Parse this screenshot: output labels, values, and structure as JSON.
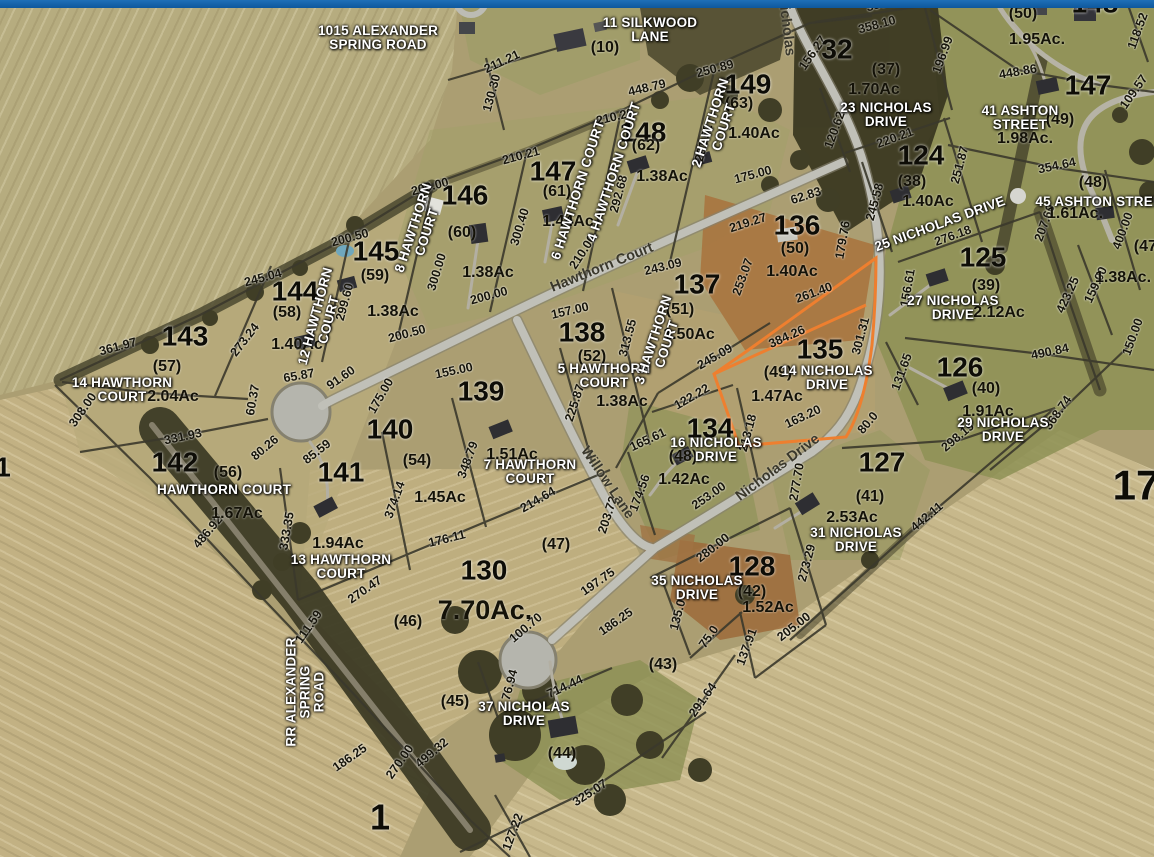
{
  "app": {
    "top_bar_color": "#1266ad",
    "highlight_color": "#ee7f2f"
  },
  "map": {
    "streets": [
      {
        "t": "Hawthorn Court",
        "x": 602,
        "y": 268,
        "r": -22
      },
      {
        "t": "Willow Lane",
        "x": 607,
        "y": 483,
        "r": 56
      },
      {
        "t": "Nicholas Drive",
        "x": 778,
        "y": 468,
        "r": -37
      },
      {
        "t": "Nicholas",
        "x": 786,
        "y": 26,
        "r": 83
      }
    ],
    "addresses": [
      {
        "lines": [
          "1015 ALEXANDER",
          "SPRING ROAD"
        ],
        "x": 378,
        "y": 38
      },
      {
        "lines": [
          "11 SILKWOOD",
          "LANE"
        ],
        "x": 650,
        "y": 30
      },
      {
        "lines": [
          "23 NICHOLAS",
          "DRIVE"
        ],
        "x": 886,
        "y": 115
      },
      {
        "lines": [
          "41 ASHTON",
          "STREET"
        ],
        "x": 1020,
        "y": 118
      },
      {
        "lines": [
          "45 ASHTON STREET"
        ],
        "x": 1103,
        "y": 202
      },
      {
        "lines": [
          "25 NICHOLAS DRIVE"
        ],
        "x": 940,
        "y": 224,
        "r": -20
      },
      {
        "lines": [
          "27 NICHOLAS",
          "DRIVE"
        ],
        "x": 953,
        "y": 308
      },
      {
        "lines": [
          "29 NICHOLAS",
          "DRIVE"
        ],
        "x": 1003,
        "y": 430
      },
      {
        "lines": [
          "31 NICHOLAS",
          "DRIVE"
        ],
        "x": 856,
        "y": 540
      },
      {
        "lines": [
          "14 NICHOLAS",
          "DRIVE"
        ],
        "x": 827,
        "y": 378
      },
      {
        "lines": [
          "16 NICHOLAS",
          "DRIVE"
        ],
        "x": 716,
        "y": 450
      },
      {
        "lines": [
          "35 NICHOLAS",
          "DRIVE"
        ],
        "x": 697,
        "y": 588
      },
      {
        "lines": [
          "37 NICHOLAS",
          "DRIVE"
        ],
        "x": 524,
        "y": 714
      },
      {
        "lines": [
          "14 HAWTHORN",
          "COURT"
        ],
        "x": 122,
        "y": 390
      },
      {
        "lines": [
          "HAWTHORN COURT"
        ],
        "x": 224,
        "y": 490
      },
      {
        "lines": [
          "5 HAWTHORN",
          "COURT"
        ],
        "x": 604,
        "y": 376
      },
      {
        "lines": [
          "7 HAWTHORN",
          "COURT"
        ],
        "x": 530,
        "y": 472
      },
      {
        "lines": [
          "13 HAWTHORN",
          "COURT"
        ],
        "x": 341,
        "y": 567
      },
      {
        "lines": [
          "3 HAWTHORN",
          "COURT"
        ],
        "x": 660,
        "y": 342,
        "r": -72
      },
      {
        "lines": [
          "2 HAWTHORN",
          "COURT"
        ],
        "x": 717,
        "y": 125,
        "r": -72
      },
      {
        "lines": [
          "4 HAWTHORN COURT"
        ],
        "x": 614,
        "y": 172,
        "r": -72
      },
      {
        "lines": [
          "6 HAWTHORN COURT"
        ],
        "x": 578,
        "y": 190,
        "r": -72
      },
      {
        "lines": [
          "8 HAWTHORN",
          "COURT"
        ],
        "x": 420,
        "y": 230,
        "r": -72
      },
      {
        "lines": [
          "12 HAWTHORN",
          "COURT"
        ],
        "x": 322,
        "y": 318,
        "r": -75
      },
      {
        "lines": [
          "RR ALEXANDER",
          "SPRING",
          "ROAD"
        ],
        "x": 305,
        "y": 692,
        "r": -90
      }
    ],
    "parcel_numbers": [
      {
        "n": "143",
        "x": 185,
        "y": 337
      },
      {
        "n": "144",
        "x": 295,
        "y": 292
      },
      {
        "n": "145",
        "x": 376,
        "y": 252
      },
      {
        "n": "146",
        "x": 465,
        "y": 196
      },
      {
        "n": "147",
        "x": 553,
        "y": 172
      },
      {
        "n": "148",
        "x": 643,
        "y": 133
      },
      {
        "n": "149",
        "x": 748,
        "y": 85
      },
      {
        "n": "137",
        "x": 697,
        "y": 285
      },
      {
        "n": "138",
        "x": 582,
        "y": 333
      },
      {
        "n": "139",
        "x": 481,
        "y": 392
      },
      {
        "n": "140",
        "x": 390,
        "y": 430
      },
      {
        "n": "141",
        "x": 341,
        "y": 473
      },
      {
        "n": "142",
        "x": 175,
        "y": 463
      },
      {
        "n": "130",
        "x": 484,
        "y": 571
      },
      {
        "n": "134",
        "x": 710,
        "y": 429
      },
      {
        "n": "135",
        "x": 820,
        "y": 350
      },
      {
        "n": "136",
        "x": 797,
        "y": 226
      },
      {
        "n": "124",
        "x": 921,
        "y": 156
      },
      {
        "n": "125",
        "x": 983,
        "y": 258
      },
      {
        "n": "126",
        "x": 960,
        "y": 368
      },
      {
        "n": "127",
        "x": 882,
        "y": 463
      },
      {
        "n": "128",
        "x": 752,
        "y": 567
      },
      {
        "n": "32",
        "x": 837,
        "y": 50
      },
      {
        "n": "17",
        "x": 1136,
        "y": 486,
        "s": 42
      },
      {
        "n": "1",
        "x": 380,
        "y": 818,
        "s": 36
      },
      {
        "n": "147",
        "x": 1088,
        "y": 86
      },
      {
        "n": "148",
        "x": 1095,
        "y": 4
      },
      {
        "n": "1",
        "x": 3,
        "y": 468
      }
    ],
    "lot_numbers": [
      {
        "t": "(57)",
        "x": 167,
        "y": 367
      },
      {
        "t": "(58)",
        "x": 287,
        "y": 313
      },
      {
        "t": "(59)",
        "x": 375,
        "y": 276
      },
      {
        "t": "(60)",
        "x": 462,
        "y": 233
      },
      {
        "t": "(61)",
        "x": 557,
        "y": 192
      },
      {
        "t": "(62)",
        "x": 646,
        "y": 146
      },
      {
        "t": "(63)",
        "x": 739,
        "y": 104
      },
      {
        "t": "(51)",
        "x": 680,
        "y": 310
      },
      {
        "t": "(52)",
        "x": 592,
        "y": 357
      },
      {
        "t": "(54)",
        "x": 417,
        "y": 461
      },
      {
        "t": "(56)",
        "x": 228,
        "y": 473
      },
      {
        "t": "(50)",
        "x": 795,
        "y": 249
      },
      {
        "t": "(49)",
        "x": 778,
        "y": 373
      },
      {
        "t": "(48)",
        "x": 683,
        "y": 457
      },
      {
        "t": "(47)",
        "x": 556,
        "y": 545
      },
      {
        "t": "(46)",
        "x": 408,
        "y": 622
      },
      {
        "t": "(45)",
        "x": 455,
        "y": 702
      },
      {
        "t": "(44)",
        "x": 562,
        "y": 754
      },
      {
        "t": "(43)",
        "x": 663,
        "y": 665
      },
      {
        "t": "(42)",
        "x": 752,
        "y": 592
      },
      {
        "t": "(41)",
        "x": 870,
        "y": 497
      },
      {
        "t": "(40)",
        "x": 986,
        "y": 389
      },
      {
        "t": "(39)",
        "x": 986,
        "y": 286
      },
      {
        "t": "(38)",
        "x": 912,
        "y": 182
      },
      {
        "t": "(37)",
        "x": 886,
        "y": 70
      },
      {
        "t": "(10)",
        "x": 605,
        "y": 48
      },
      {
        "t": "(50)",
        "x": 1023,
        "y": 14
      },
      {
        "t": "(49)",
        "x": 1060,
        "y": 120
      },
      {
        "t": "(48)",
        "x": 1093,
        "y": 183
      },
      {
        "t": "(47)",
        "x": 1148,
        "y": 247
      }
    ],
    "acreages": [
      {
        "t": "2.04Ac",
        "x": 173,
        "y": 397
      },
      {
        "t": "1.40Ac",
        "x": 297,
        "y": 345
      },
      {
        "t": "1.38Ac",
        "x": 393,
        "y": 312
      },
      {
        "t": "1.38Ac",
        "x": 488,
        "y": 273
      },
      {
        "t": "1.44Ac",
        "x": 568,
        "y": 222
      },
      {
        "t": "1.38Ac",
        "x": 662,
        "y": 177
      },
      {
        "t": "1.40Ac",
        "x": 754,
        "y": 134
      },
      {
        "t": "1.50Ac",
        "x": 689,
        "y": 335
      },
      {
        "t": "1.38Ac",
        "x": 622,
        "y": 402
      },
      {
        "t": "1.51Ac",
        "x": 512,
        "y": 455
      },
      {
        "t": "1.45Ac",
        "x": 440,
        "y": 498
      },
      {
        "t": "1.94Ac",
        "x": 338,
        "y": 544
      },
      {
        "t": "1.67Ac",
        "x": 237,
        "y": 514
      },
      {
        "t": "7.70Ac.",
        "x": 485,
        "y": 611,
        "s": 27
      },
      {
        "t": "1.42Ac",
        "x": 684,
        "y": 480
      },
      {
        "t": "1.47Ac",
        "x": 777,
        "y": 397
      },
      {
        "t": "1.40Ac",
        "x": 792,
        "y": 272
      },
      {
        "t": "1.40Ac",
        "x": 928,
        "y": 202
      },
      {
        "t": "2.12Ac",
        "x": 999,
        "y": 313
      },
      {
        "t": "1.91Ac",
        "x": 988,
        "y": 412
      },
      {
        "t": "2.53Ac",
        "x": 852,
        "y": 518
      },
      {
        "t": "1.52Ac",
        "x": 768,
        "y": 608
      },
      {
        "t": "1.70Ac",
        "x": 874,
        "y": 90
      },
      {
        "t": "1.95Ac.",
        "x": 1037,
        "y": 40
      },
      {
        "t": "1.98Ac.",
        "x": 1025,
        "y": 139
      },
      {
        "t": "1.61Ac.",
        "x": 1075,
        "y": 214
      },
      {
        "t": "1.38Ac.",
        "x": 1123,
        "y": 278
      }
    ],
    "dimensions": [
      {
        "t": "245.04",
        "x": 263,
        "y": 278,
        "r": -15
      },
      {
        "t": "361.97",
        "x": 118,
        "y": 347,
        "r": -15
      },
      {
        "t": "273.24",
        "x": 245,
        "y": 340,
        "r": -52
      },
      {
        "t": "299.60",
        "x": 345,
        "y": 302,
        "r": -75
      },
      {
        "t": "200.50",
        "x": 350,
        "y": 238,
        "r": -15
      },
      {
        "t": "200.50",
        "x": 407,
        "y": 334,
        "r": -15
      },
      {
        "t": "200.00",
        "x": 430,
        "y": 187,
        "r": -15
      },
      {
        "t": "200.00",
        "x": 489,
        "y": 296,
        "r": -15
      },
      {
        "t": "300.00",
        "x": 437,
        "y": 272,
        "r": -73
      },
      {
        "t": "210.21",
        "x": 521,
        "y": 156,
        "r": -15
      },
      {
        "t": "300.40",
        "x": 520,
        "y": 227,
        "r": -73
      },
      {
        "t": "292.68",
        "x": 619,
        "y": 194,
        "r": -75
      },
      {
        "t": "210.29",
        "x": 615,
        "y": 117,
        "r": -13
      },
      {
        "t": "448.79",
        "x": 647,
        "y": 88,
        "r": -13
      },
      {
        "t": "211.21",
        "x": 502,
        "y": 62,
        "r": -25
      },
      {
        "t": "130.30",
        "x": 492,
        "y": 93,
        "r": -75
      },
      {
        "t": "281.52",
        "x": 704,
        "y": 143,
        "r": -75
      },
      {
        "t": "250.89",
        "x": 715,
        "y": 69,
        "r": -15
      },
      {
        "t": "175.00",
        "x": 753,
        "y": 175,
        "r": -15
      },
      {
        "t": "210.00",
        "x": 583,
        "y": 252,
        "r": -57
      },
      {
        "t": "157.00",
        "x": 570,
        "y": 311,
        "r": -13
      },
      {
        "t": "243.09",
        "x": 663,
        "y": 267,
        "r": -14
      },
      {
        "t": "313.55",
        "x": 628,
        "y": 338,
        "r": -75
      },
      {
        "t": "225.87",
        "x": 575,
        "y": 403,
        "r": -72
      },
      {
        "t": "245.09",
        "x": 715,
        "y": 357,
        "r": -30
      },
      {
        "t": "253.07",
        "x": 743,
        "y": 277,
        "r": -70
      },
      {
        "t": "219.27",
        "x": 748,
        "y": 223,
        "r": -18
      },
      {
        "t": "62.83",
        "x": 806,
        "y": 196,
        "r": -18
      },
      {
        "t": "179.76",
        "x": 843,
        "y": 240,
        "r": -80
      },
      {
        "t": "261.40",
        "x": 814,
        "y": 293,
        "r": -20
      },
      {
        "t": "384.26",
        "x": 787,
        "y": 337,
        "r": -24
      },
      {
        "t": "163.20",
        "x": 803,
        "y": 417,
        "r": -25
      },
      {
        "t": "213.18",
        "x": 748,
        "y": 433,
        "r": -75
      },
      {
        "t": "122.22",
        "x": 692,
        "y": 397,
        "r": -30
      },
      {
        "t": "165.61",
        "x": 648,
        "y": 440,
        "r": -25
      },
      {
        "t": "174.56",
        "x": 640,
        "y": 493,
        "r": -70
      },
      {
        "t": "253.00",
        "x": 709,
        "y": 496,
        "r": -35
      },
      {
        "t": "280.00",
        "x": 713,
        "y": 548,
        "r": -38
      },
      {
        "t": "277.70",
        "x": 797,
        "y": 482,
        "r": -80
      },
      {
        "t": "273.29",
        "x": 807,
        "y": 563,
        "r": -75
      },
      {
        "t": "205.00",
        "x": 794,
        "y": 627,
        "r": -38
      },
      {
        "t": "137.91",
        "x": 747,
        "y": 647,
        "r": -70
      },
      {
        "t": "135.0",
        "x": 678,
        "y": 615,
        "r": -75
      },
      {
        "t": "75.0",
        "x": 709,
        "y": 637,
        "r": -55
      },
      {
        "t": "186.25",
        "x": 616,
        "y": 622,
        "r": -35
      },
      {
        "t": "197.75",
        "x": 598,
        "y": 582,
        "r": -35
      },
      {
        "t": "203.72",
        "x": 608,
        "y": 515,
        "r": -72
      },
      {
        "t": "214.64",
        "x": 538,
        "y": 500,
        "r": -30
      },
      {
        "t": "176.11",
        "x": 447,
        "y": 539,
        "r": -14
      },
      {
        "t": "348.79",
        "x": 468,
        "y": 460,
        "r": -70
      },
      {
        "t": "374.14",
        "x": 395,
        "y": 500,
        "r": -70
      },
      {
        "t": "333.35",
        "x": 287,
        "y": 531,
        "r": -80
      },
      {
        "t": "155.00",
        "x": 454,
        "y": 371,
        "r": -12
      },
      {
        "t": "175.00",
        "x": 381,
        "y": 396,
        "r": -60
      },
      {
        "t": "85.59",
        "x": 317,
        "y": 452,
        "r": -38
      },
      {
        "t": "65.87",
        "x": 299,
        "y": 376,
        "r": -10
      },
      {
        "t": "91.60",
        "x": 341,
        "y": 378,
        "r": -35
      },
      {
        "t": "60.37",
        "x": 253,
        "y": 400,
        "r": -80
      },
      {
        "t": "331.93",
        "x": 183,
        "y": 437,
        "r": -12
      },
      {
        "t": "308.00",
        "x": 83,
        "y": 410,
        "r": -55
      },
      {
        "t": "80.26",
        "x": 265,
        "y": 448,
        "r": -40
      },
      {
        "t": "486.92",
        "x": 208,
        "y": 532,
        "r": -50
      },
      {
        "t": "270.47",
        "x": 365,
        "y": 590,
        "r": -35
      },
      {
        "t": "111.59",
        "x": 309,
        "y": 627,
        "r": -55
      },
      {
        "t": "186.25",
        "x": 350,
        "y": 758,
        "r": -35
      },
      {
        "t": "270.00",
        "x": 400,
        "y": 762,
        "r": -55
      },
      {
        "t": "499.32",
        "x": 432,
        "y": 753,
        "r": -40
      },
      {
        "t": "325.07",
        "x": 590,
        "y": 793,
        "r": -33
      },
      {
        "t": "127.22",
        "x": 513,
        "y": 832,
        "r": -70
      },
      {
        "t": "291.64",
        "x": 703,
        "y": 700,
        "r": -55
      },
      {
        "t": "714.44",
        "x": 565,
        "y": 687,
        "r": -25
      },
      {
        "t": "76.94",
        "x": 510,
        "y": 685,
        "r": -75
      },
      {
        "t": "100.70",
        "x": 526,
        "y": 628,
        "r": -40
      },
      {
        "t": "245.58",
        "x": 875,
        "y": 202,
        "r": -75
      },
      {
        "t": "251.87",
        "x": 960,
        "y": 165,
        "r": -75
      },
      {
        "t": "276.18",
        "x": 953,
        "y": 236,
        "r": -20
      },
      {
        "t": "156.61",
        "x": 908,
        "y": 288,
        "r": -80
      },
      {
        "t": "301.31",
        "x": 861,
        "y": 336,
        "r": -75
      },
      {
        "t": "131.65",
        "x": 902,
        "y": 372,
        "r": -70
      },
      {
        "t": "298.19",
        "x": 958,
        "y": 437,
        "r": -40
      },
      {
        "t": "80.0",
        "x": 868,
        "y": 423,
        "r": -50
      },
      {
        "t": "442.11",
        "x": 927,
        "y": 517,
        "r": -40
      },
      {
        "t": "490.84",
        "x": 1050,
        "y": 352,
        "r": -12
      },
      {
        "t": "368.74",
        "x": 1058,
        "y": 413,
        "r": -55
      },
      {
        "t": "150.00",
        "x": 1133,
        "y": 337,
        "r": -70
      },
      {
        "t": "448.86",
        "x": 1018,
        "y": 72,
        "r": -10
      },
      {
        "t": "118.52",
        "x": 1138,
        "y": 31,
        "r": -70
      },
      {
        "t": "109.57",
        "x": 1134,
        "y": 92,
        "r": -55
      },
      {
        "t": "354.64",
        "x": 1057,
        "y": 166,
        "r": -12
      },
      {
        "t": "400.00",
        "x": 1123,
        "y": 231,
        "r": -70
      },
      {
        "t": "423.25",
        "x": 1068,
        "y": 295,
        "r": -65
      },
      {
        "t": "159.00",
        "x": 1096,
        "y": 285,
        "r": -65
      },
      {
        "t": "207.60",
        "x": 1045,
        "y": 223,
        "r": -70
      },
      {
        "t": "358.10",
        "x": 877,
        "y": 25,
        "r": -15
      },
      {
        "t": "358.10",
        "x": 885,
        "y": 3,
        "r": -15
      },
      {
        "t": "156.27",
        "x": 813,
        "y": 53,
        "r": -55
      },
      {
        "t": "120.62",
        "x": 835,
        "y": 130,
        "r": -70
      },
      {
        "t": "196.99",
        "x": 943,
        "y": 55,
        "r": -70
      },
      {
        "t": "220.21",
        "x": 895,
        "y": 138,
        "r": -20
      }
    ]
  }
}
